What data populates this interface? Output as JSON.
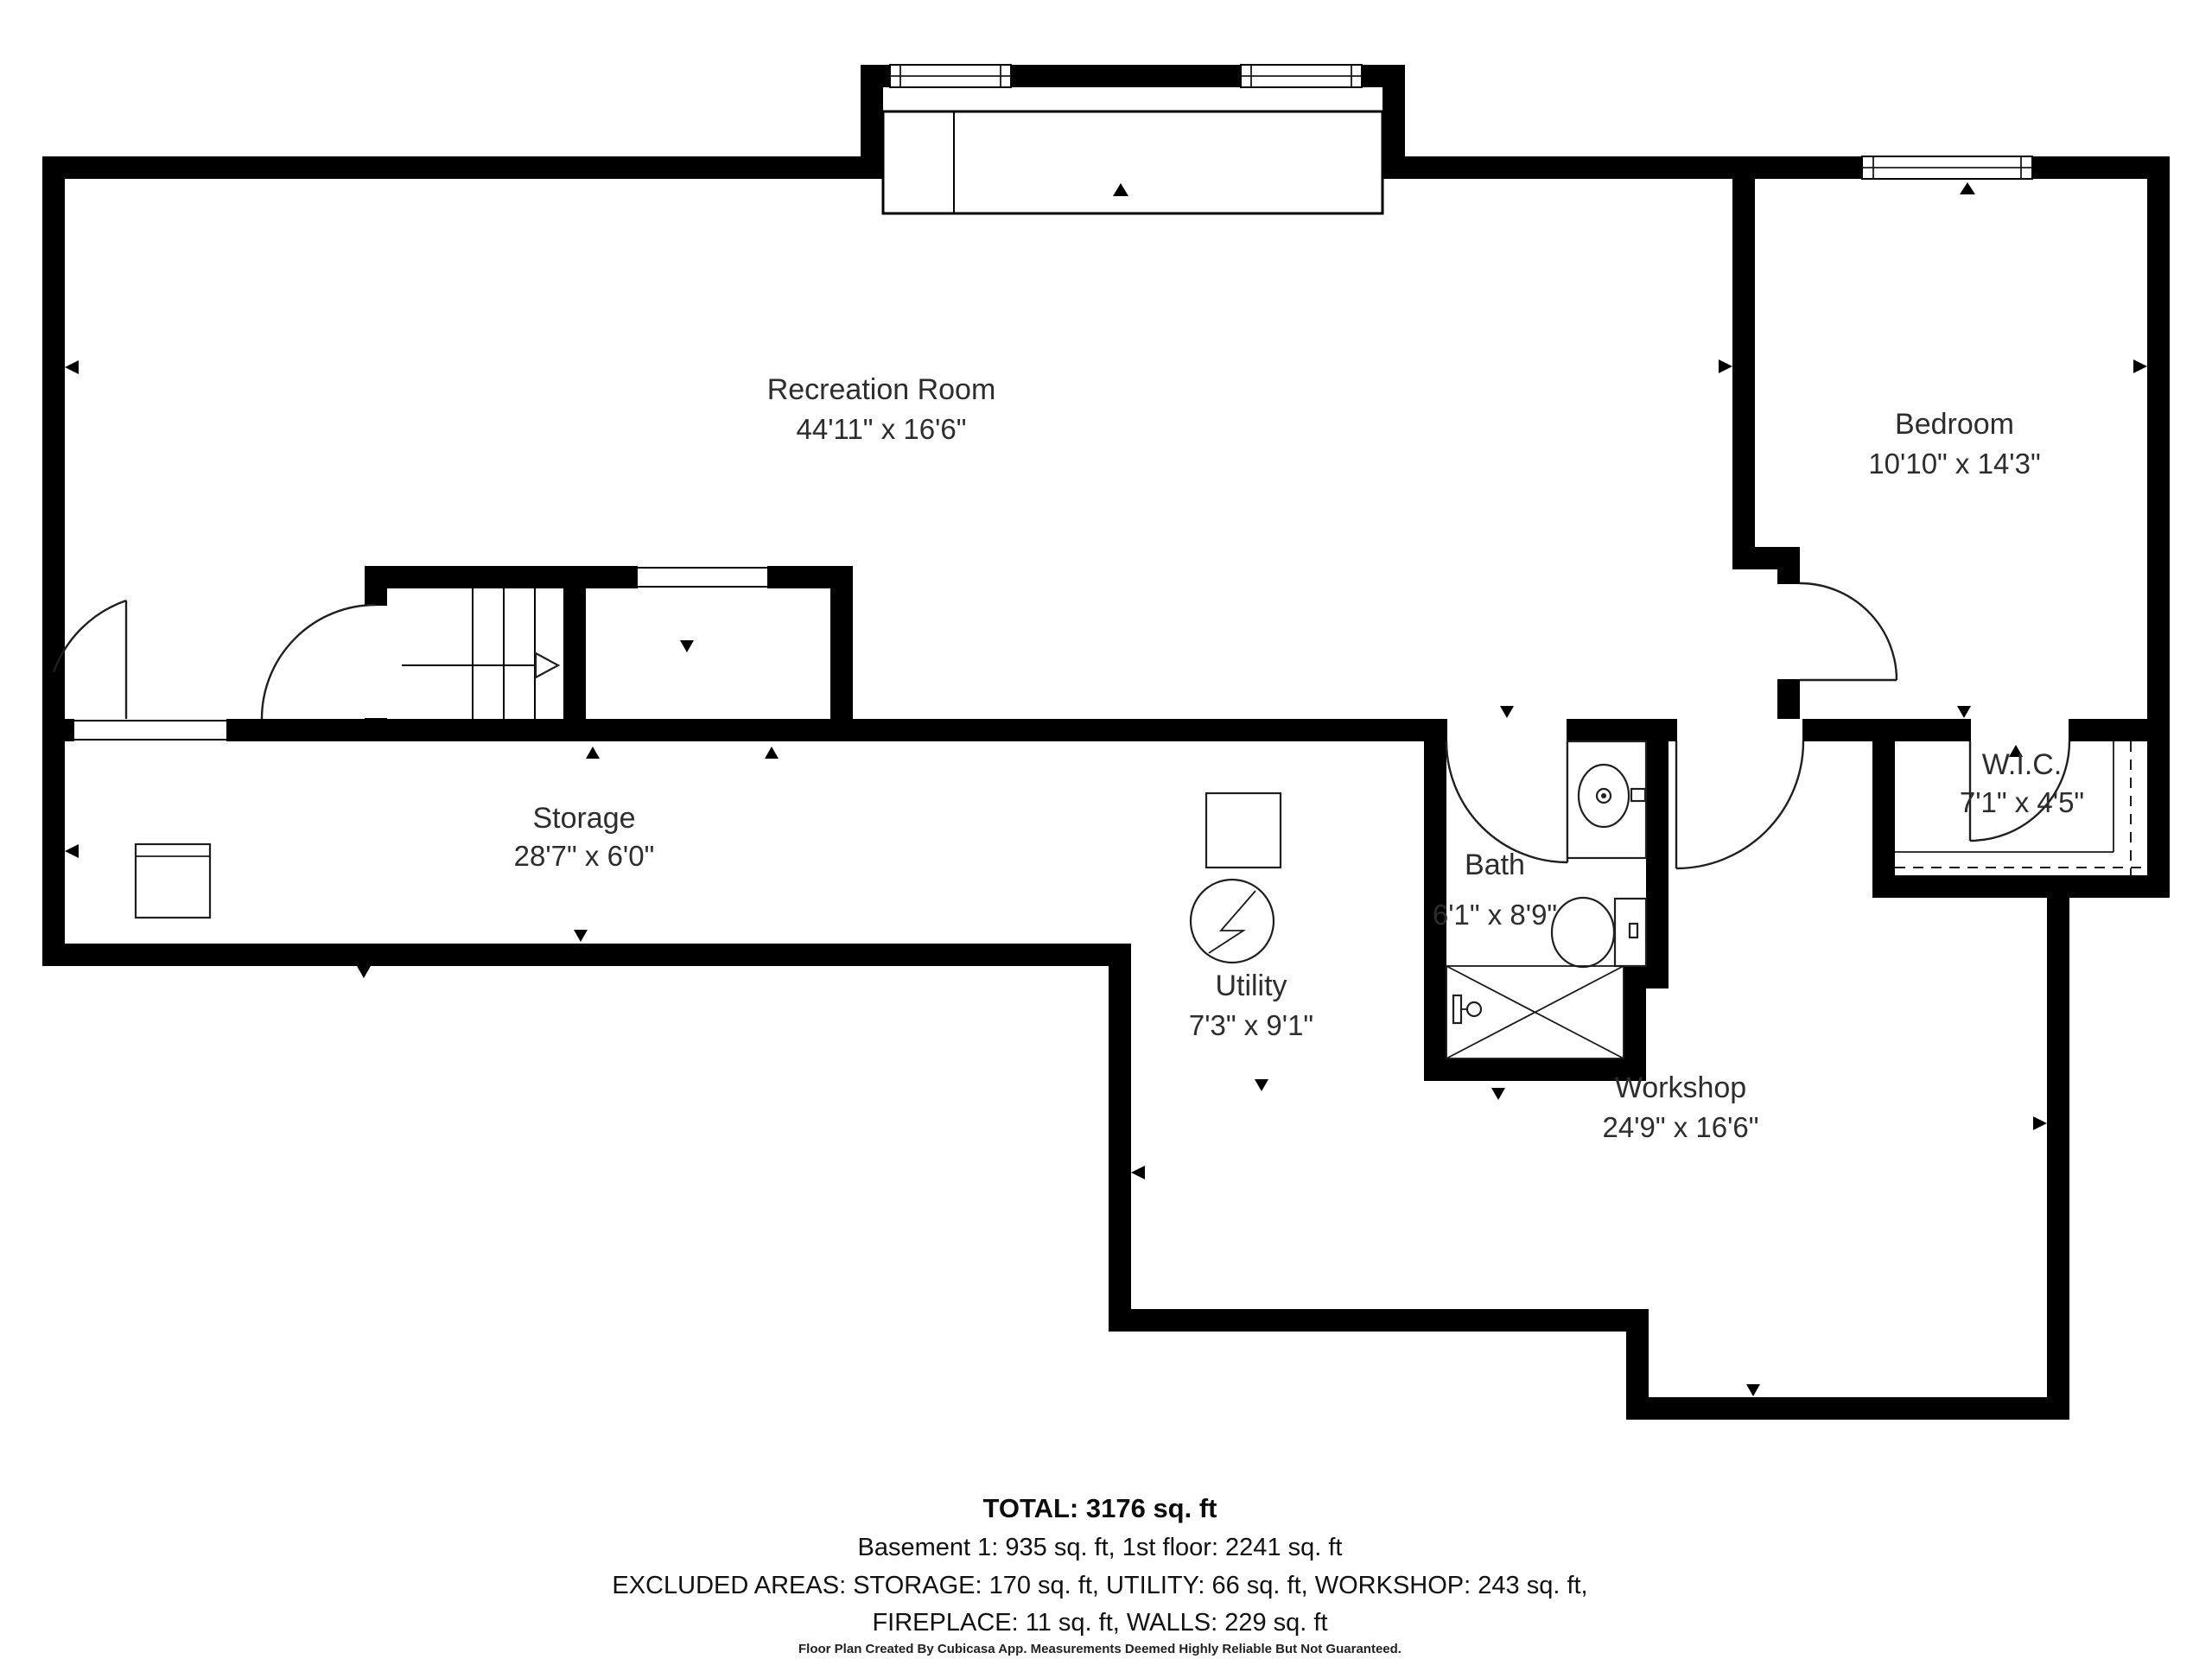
{
  "plan": {
    "rooms": {
      "recreation": {
        "name": "Recreation Room",
        "dims": "44'11\" x 16'6\""
      },
      "bedroom": {
        "name": "Bedroom",
        "dims": "10'10\" x 14'3\""
      },
      "storage": {
        "name": "Storage",
        "dims": "28'7\" x 6'0\""
      },
      "bath": {
        "name": "Bath",
        "dims": "6'1\" x 8'9\""
      },
      "utility": {
        "name": "Utility",
        "dims": "7'3\" x 9'1\""
      },
      "workshop": {
        "name": "Workshop",
        "dims": "24'9\" x 16'6\""
      },
      "wic": {
        "name": "W.I.C.",
        "dims": "7'1\" x 4'5\""
      }
    },
    "summary": {
      "total": "TOTAL: 3176 sq. ft",
      "floors": "Basement 1: 935 sq. ft, 1st floor: 2241 sq. ft",
      "excluded1": "EXCLUDED AREAS: STORAGE: 170 sq. ft, UTILITY: 66 sq. ft, WORKSHOP: 243 sq. ft,",
      "excluded2": "FIREPLACE: 11 sq. ft, WALLS: 229 sq. ft",
      "footer": "Floor Plan Created By Cubicasa App. Measurements Deemed Highly Reliable But Not Guaranteed."
    },
    "colors": {
      "wall": "#000000",
      "background": "#ffffff",
      "label_text": "#2d2d2d",
      "summary_text": "#111111"
    }
  }
}
